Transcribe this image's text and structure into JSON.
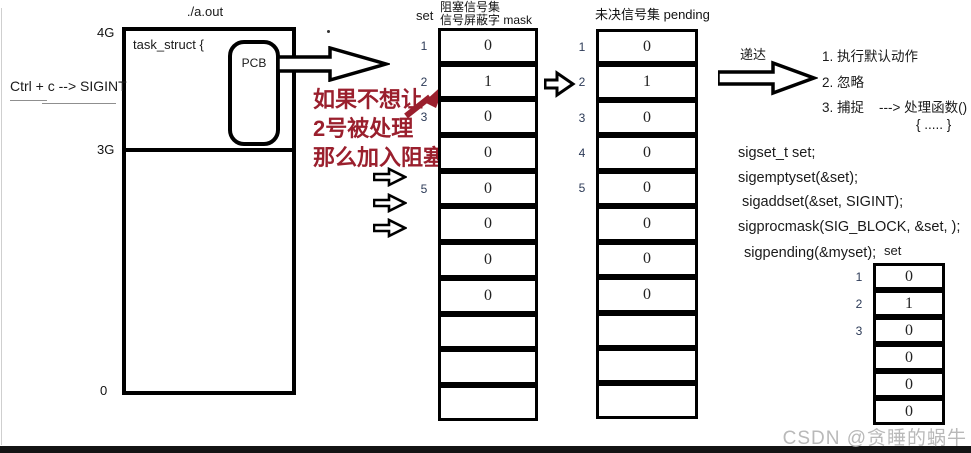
{
  "process": {
    "title": "./a.out",
    "task_struct_label": "task_struct {",
    "pcb_label": "PCB",
    "mem_4g": "4G",
    "mem_3g": "3G",
    "mem_0": "0",
    "signal_source": "Ctrl + c --> SIGINT"
  },
  "red_note": {
    "line1": "如果不想让",
    "line2": "2号被处理",
    "line3": "那么加入阻塞",
    "color": "#9a1f2d"
  },
  "mask_table": {
    "set_label": "set",
    "title_line1": "阻塞信号集",
    "title_line2": "信号屏蔽字 mask",
    "rows": [
      {
        "label": "1",
        "value": "0"
      },
      {
        "label": "2",
        "value": "1"
      },
      {
        "label": "3",
        "value": "0"
      },
      {
        "label": "",
        "value": "0"
      },
      {
        "label": "5",
        "value": "0"
      },
      {
        "label": "",
        "value": "0"
      },
      {
        "label": "",
        "value": "0"
      },
      {
        "label": "",
        "value": "0"
      },
      {
        "label": "",
        "value": ""
      },
      {
        "label": "",
        "value": ""
      },
      {
        "label": "",
        "value": ""
      }
    ]
  },
  "pending_table": {
    "title": "未决信号集 pending",
    "rows": [
      {
        "label": "1",
        "value": "0"
      },
      {
        "label": "2",
        "value": "1"
      },
      {
        "label": "3",
        "value": "0"
      },
      {
        "label": "4",
        "value": "0"
      },
      {
        "label": "5",
        "value": "0"
      },
      {
        "label": "",
        "value": "0"
      },
      {
        "label": "",
        "value": "0"
      },
      {
        "label": "",
        "value": "0"
      },
      {
        "label": "",
        "value": ""
      },
      {
        "label": "",
        "value": ""
      },
      {
        "label": "",
        "value": ""
      }
    ]
  },
  "delivery": {
    "label": "递达",
    "item1": "1. 执行默认动作",
    "item2": "2. 忽略",
    "item3": "3. 捕捉",
    "handler_arrow": "---> 处理函数()",
    "handler_body": "{ ..... }"
  },
  "code": {
    "line1": "sigset_t set;",
    "line2": "sigemptyset(&set);",
    "line3": "sigaddset(&set, SIGINT);",
    "line4": "sigprocmask(SIG_BLOCK, &set, );",
    "line5": "sigpending(&myset);",
    "result_label": "set"
  },
  "result_table": {
    "rows": [
      {
        "label": "1",
        "value": "0"
      },
      {
        "label": "2",
        "value": "1"
      },
      {
        "label": "3",
        "value": "0"
      },
      {
        "label": "",
        "value": "0"
      },
      {
        "label": "",
        "value": "0"
      },
      {
        "label": "",
        "value": "0"
      }
    ]
  },
  "watermark": "CSDN @贪睡的蜗牛"
}
